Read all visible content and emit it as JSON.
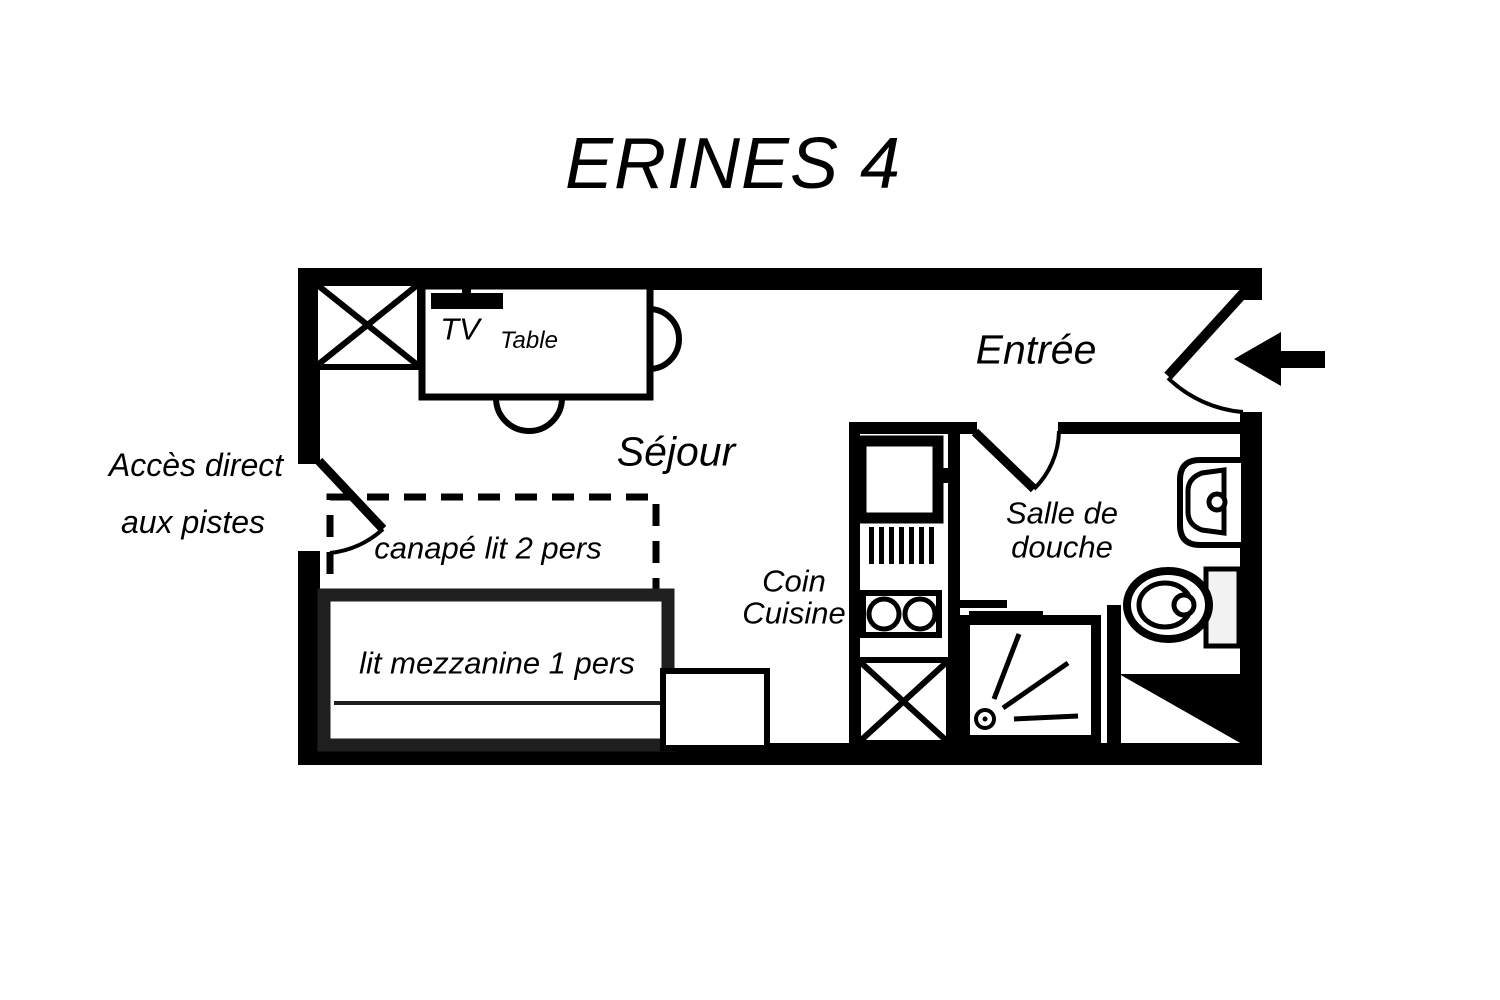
{
  "title": "ERINES 4",
  "labels": {
    "access_line1": "Accès direct",
    "access_line2": "aux pistes",
    "tv": "TV",
    "table": "Table",
    "entree": "Entrée",
    "sejour": "Séjour",
    "canape": "canapé lit 2 pers",
    "coin_line1": "Coin",
    "coin_line2": "Cuisine",
    "lit": "lit mezzanine 1 pers",
    "salle_line1": "Salle de",
    "salle_line2": "douche"
  },
  "colors": {
    "ink": "#000000",
    "paper": "#ffffff",
    "bed_border": "#1f1f1f",
    "toilet_tank_fill": "#f2f2f2"
  },
  "symbols": [
    "closet-cross",
    "tv-set",
    "dining-table",
    "chair",
    "entrance-door-swing",
    "entrance-arrow",
    "slope-access-door-swing",
    "sofa-bed-dashed",
    "mezzanine-bed",
    "side-unit",
    "fridge-unit",
    "dish-rack",
    "hob-two-burners",
    "storage-cross",
    "bathroom-door-swing",
    "shower-tray",
    "shower-spray",
    "washbasin",
    "toilet",
    "corner-wall-triangle"
  ]
}
